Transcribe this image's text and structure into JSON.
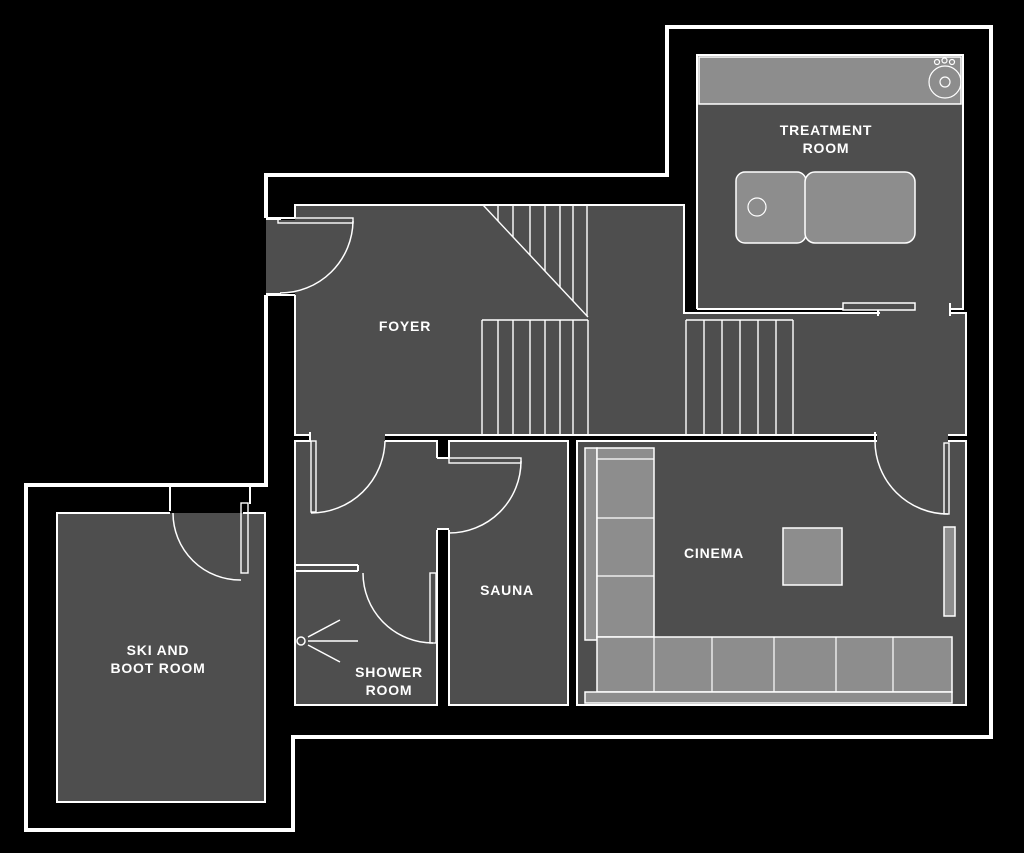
{
  "colors": {
    "background": "#000000",
    "room_fill": "#4e4e4e",
    "furniture_fill": "#8d8d8d",
    "line": "#ffffff"
  },
  "rooms": {
    "foyer": {
      "name": "FOYER"
    },
    "treatment": {
      "name_line1": "TREATMENT",
      "name_line2": "ROOM"
    },
    "cinema": {
      "name": "CINEMA"
    },
    "sauna": {
      "name": "SAUNA"
    },
    "shower": {
      "name_line1": "SHOWER",
      "name_line2": "ROOM"
    },
    "ski_boot": {
      "name_line1": "SKI AND",
      "name_line2": "BOOT ROOM"
    }
  },
  "features": {
    "sink": "sink",
    "massage_table": "massage-table",
    "corner_sofa": "corner-sofa",
    "coffee_table": "coffee-table",
    "tv_screen": "tv-screen",
    "shower_head": "shower-head",
    "main_staircase": "staircase",
    "secondary_staircase": "staircase"
  }
}
